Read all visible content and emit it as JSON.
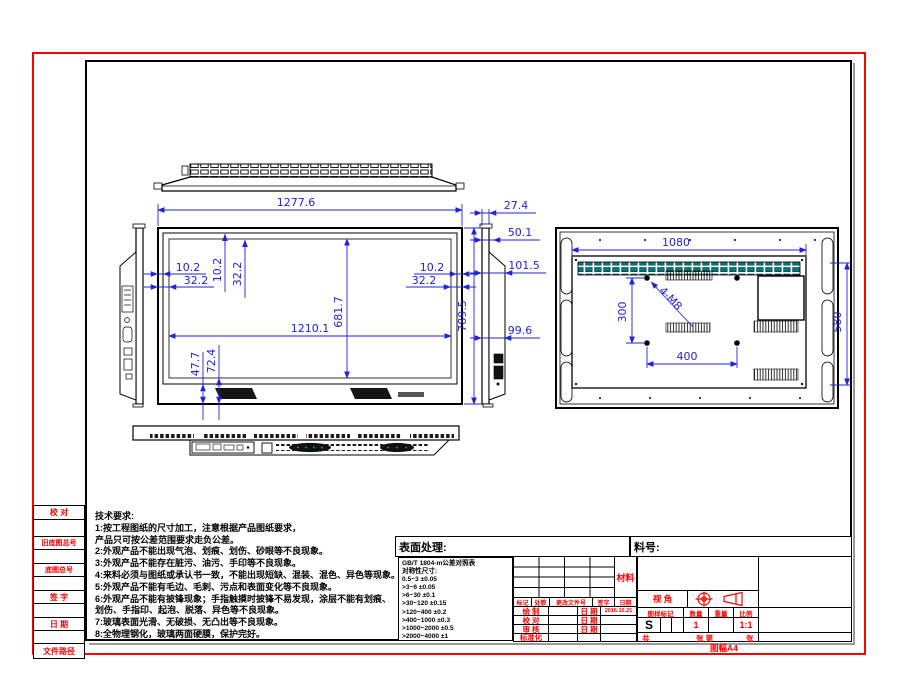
{
  "colors": {
    "dimension_blue": "#2222dd",
    "frame_red": "#ff0000",
    "vent_teal": "#007878"
  },
  "sidebar": {
    "items": [
      "校 对",
      "",
      "旧底图总号",
      "",
      "底图总号",
      "",
      "签 字",
      "",
      "日 期",
      "",
      "文件路径"
    ]
  },
  "notes": {
    "title": "技术要求:",
    "lines": [
      "1:按工程图纸的尺寸加工，注意根据产品图纸要求，",
      "产品只可按公差范围要求走负公差。",
      "2:外观产品不能出现气泡、划痕、划伤、砂眼等不良现象。",
      "3:外观产品不能存在脏污、油污、手印等不良现象。",
      "4:来料必须与图纸或承认书一致，不能出现短缺、混装、混色、异色等现象。",
      "5:外观产品不能有毛边、毛刺、污点和表面变化等不良现象。",
      "6:外观产品不能有披锋现象；手指触摸时披锋不易发现，涂层不能有划痕、",
      "划伤、手指印、起泡、脱落、异色等不良现象。",
      "7:玻璃表面光滑、无破损、无凸出等不良现象。",
      "8:全物理钢化，玻璃两面硬膜，保护完好。"
    ]
  },
  "drawing": {
    "front": {
      "w": "1277.6",
      "iw": "1210.1",
      "ih": "681.7",
      "h": "789.5",
      "t1": "10.2",
      "t2": "32.2",
      "l1": "10.2",
      "l2": "32.2",
      "r1": "10.2",
      "r2": "32.2",
      "b1": "47.7",
      "b2": "72.4"
    },
    "side": {
      "d1": "27.4",
      "d2": "50.1",
      "d3": "101.5",
      "d4": "99.6"
    },
    "back": {
      "w": "1080",
      "h": "580",
      "vx": "400",
      "vy": "300",
      "holes": "4-M8"
    }
  },
  "title_block": {
    "surface_treatment_label": "表面处理:",
    "part_number_label": "料号:",
    "material_label": "材料",
    "tolerance_table": {
      "header": "GB/T 1804-m公差对照表",
      "subheader": "对称性尺寸:",
      "rows": [
        "0.5~3  ±0.05",
        ">3~6  ±0.05",
        ">6~30  ±0.1",
        ">30~120  ±0.15",
        ">120~400  ±0.2",
        ">400~1000  ±0.3",
        ">1000~2000  ±0.5",
        ">2000~4000  ±1"
      ]
    },
    "revision_header": {
      "mark": "标记",
      "count": "处数",
      "change_doc": "更改文件号",
      "sign": "签字",
      "date": "日期"
    },
    "approval_rows": [
      {
        "role": "绘 制",
        "date_label": "日 期",
        "value": "2016.10.21"
      },
      {
        "role": "校 对",
        "date_label": "日 期",
        "value": ""
      },
      {
        "role": "审 核",
        "date_label": "日 期",
        "value": ""
      },
      {
        "role": "标准化",
        "date_label": "",
        "value": ""
      }
    ],
    "projection_label": "视  角",
    "spec_header": {
      "mark": "图样标记",
      "qty": "数量",
      "weight": "重量",
      "scale": "比例"
    },
    "spec_values": {
      "mark": "S",
      "qty": "1",
      "weight": "",
      "scale": "1:1"
    },
    "sheet_row": {
      "total_label": "共",
      "sheet_label": "张 第",
      "page_label": "张"
    },
    "sheet_size": "图幅A4"
  }
}
